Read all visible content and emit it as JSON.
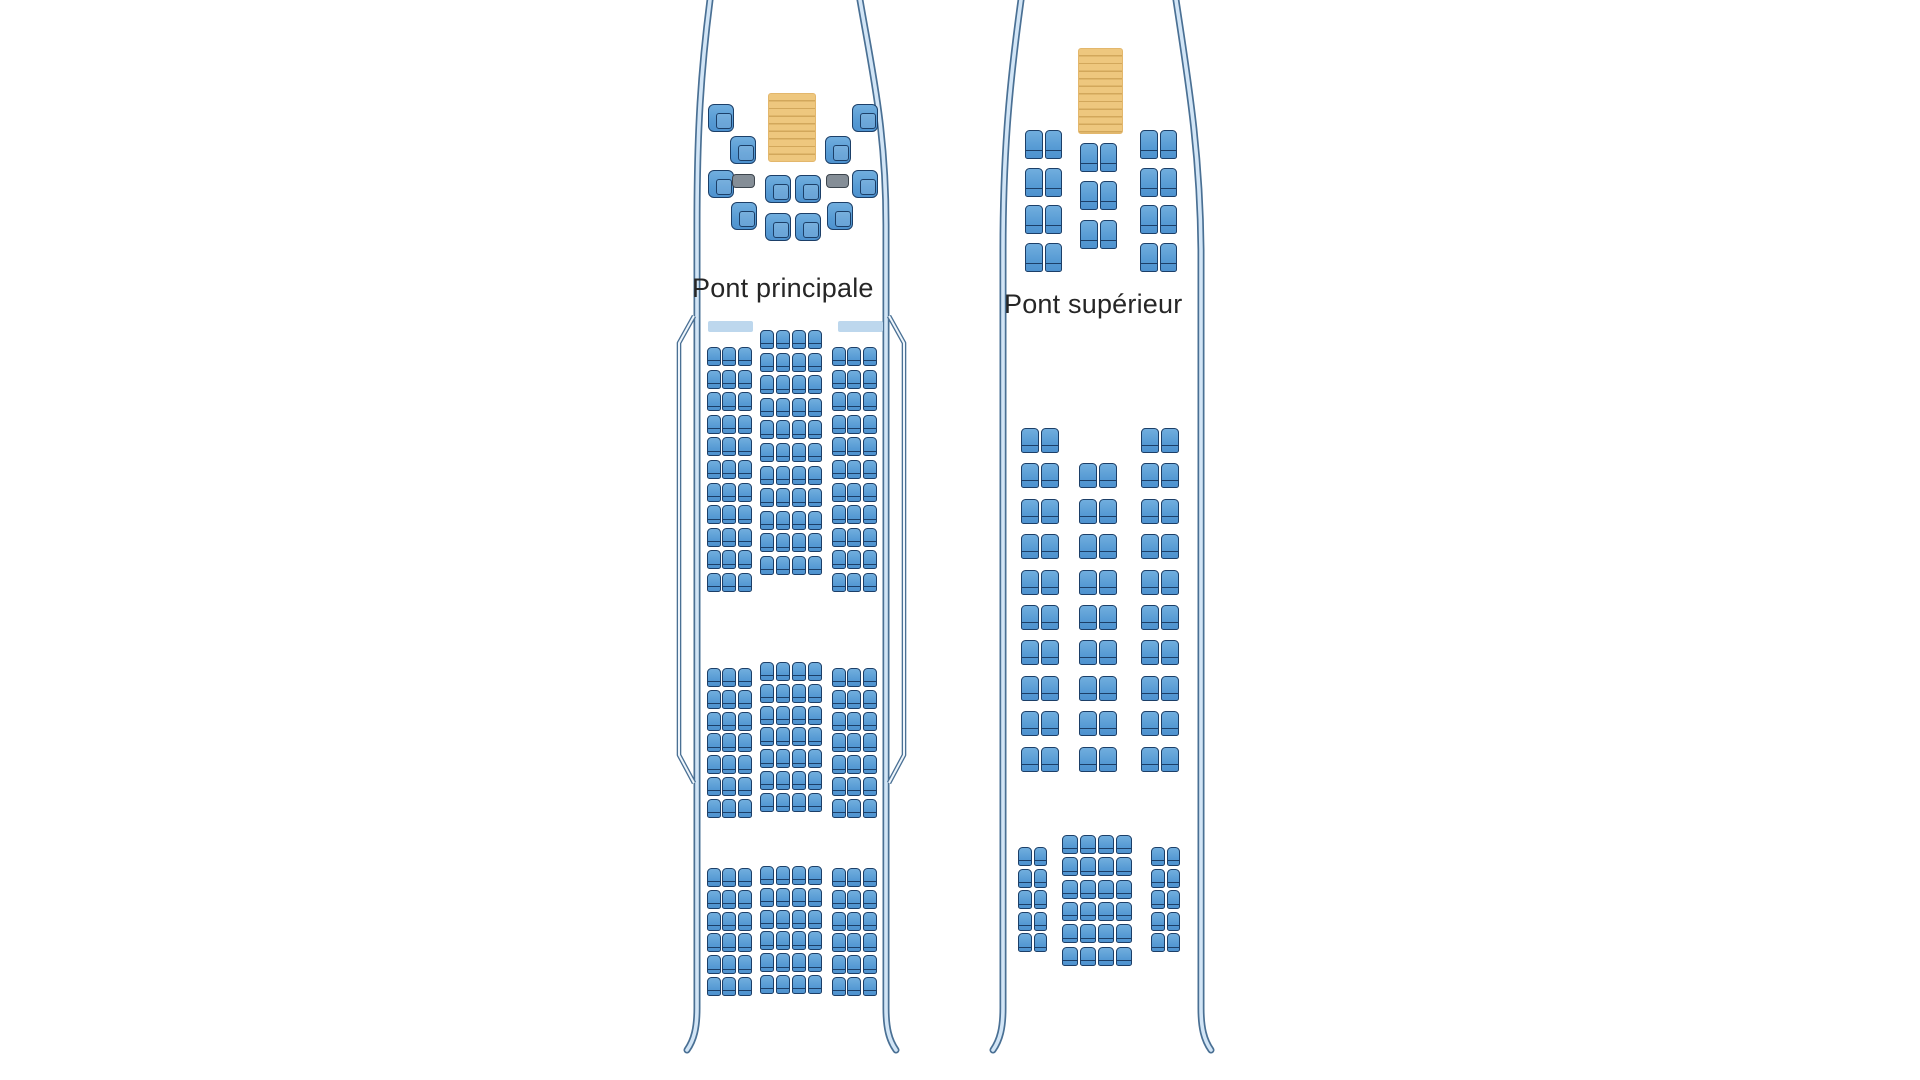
{
  "diagram_type": "aircraft-seat-map",
  "colors": {
    "seat_fill": "#5b9bd5",
    "seat_border": "#1c3f68",
    "ottoman_fill": "#858e97",
    "ottoman_border": "#3d454d",
    "stairs_fill": "#eec77e",
    "stairs_step_line": "#d2a75b",
    "exit_marker_fill": "#bdd7ed",
    "fuselage_outline_dark": "#4a7094",
    "fuselage_outline_light": "#d2e5f6",
    "label_text": "#262626",
    "background": "#ffffff"
  },
  "decks": [
    {
      "id": "pont-principal",
      "label": "Pont principale",
      "stairs": {
        "x": 768,
        "y": 93,
        "w": 48,
        "h": 69
      },
      "exit_markers": [
        {
          "x": 708,
          "y": 321,
          "w": 45,
          "h": 11
        },
        {
          "x": 838,
          "y": 321,
          "w": 45,
          "h": 11
        }
      ],
      "first_class_seats": {
        "w": 26,
        "h": 28,
        "positions": [
          [
            708,
            104
          ],
          [
            852,
            104
          ],
          [
            730,
            136
          ],
          [
            825,
            136
          ],
          [
            708,
            170
          ],
          [
            765,
            175
          ],
          [
            795,
            175
          ],
          [
            852,
            170
          ],
          [
            731,
            202
          ],
          [
            765,
            213
          ],
          [
            795,
            213
          ],
          [
            827,
            202
          ]
        ]
      },
      "ottomans": {
        "w": 23,
        "h": 14,
        "positions": [
          [
            732,
            174
          ],
          [
            826,
            174
          ]
        ]
      },
      "seat_blocks": [
        {
          "section": "avant",
          "pos": "left",
          "class_name": "economy",
          "style": "eco",
          "x": 707,
          "y": 347,
          "cols": 3,
          "col_pitch": 15.4,
          "rows": 11,
          "row_pitch": 22.6,
          "seat_w": 13.8,
          "seat_h": 19
        },
        {
          "section": "avant",
          "pos": "center",
          "class_name": "economy",
          "style": "eco",
          "x": 760,
          "y": 330,
          "cols": 4,
          "col_pitch": 15.9,
          "rows": 11,
          "row_pitch": 22.6,
          "seat_w": 14.2,
          "seat_h": 19
        },
        {
          "section": "avant",
          "pos": "right",
          "class_name": "economy",
          "style": "eco",
          "x": 832,
          "y": 347,
          "cols": 3,
          "col_pitch": 15.4,
          "rows": 11,
          "row_pitch": 22.6,
          "seat_w": 13.8,
          "seat_h": 19
        },
        {
          "section": "milieu",
          "pos": "left",
          "class_name": "economy",
          "style": "eco",
          "x": 707,
          "y": 668,
          "cols": 3,
          "col_pitch": 15.4,
          "rows": 7,
          "row_pitch": 21.8,
          "seat_w": 13.8,
          "seat_h": 19
        },
        {
          "section": "milieu",
          "pos": "center",
          "class_name": "economy",
          "style": "eco",
          "x": 760,
          "y": 662,
          "cols": 4,
          "col_pitch": 15.9,
          "rows": 7,
          "row_pitch": 21.8,
          "seat_w": 14.2,
          "seat_h": 19
        },
        {
          "section": "milieu",
          "pos": "right",
          "class_name": "economy",
          "style": "eco",
          "x": 832,
          "y": 668,
          "cols": 3,
          "col_pitch": 15.4,
          "rows": 7,
          "row_pitch": 21.8,
          "seat_w": 13.8,
          "seat_h": 19
        },
        {
          "section": "arriere",
          "pos": "left",
          "class_name": "economy",
          "style": "eco",
          "x": 707,
          "y": 868,
          "cols": 3,
          "col_pitch": 15.4,
          "rows": 6,
          "row_pitch": 21.8,
          "seat_w": 13.8,
          "seat_h": 19
        },
        {
          "section": "arriere",
          "pos": "center",
          "class_name": "economy",
          "style": "eco",
          "x": 760,
          "y": 866,
          "cols": 4,
          "col_pitch": 15.9,
          "rows": 6,
          "row_pitch": 21.8,
          "seat_w": 14.2,
          "seat_h": 19
        },
        {
          "section": "arriere",
          "pos": "right",
          "class_name": "economy",
          "style": "eco",
          "x": 832,
          "y": 868,
          "cols": 3,
          "col_pitch": 15.4,
          "rows": 6,
          "row_pitch": 21.8,
          "seat_w": 13.8,
          "seat_h": 19
        }
      ]
    },
    {
      "id": "pont-superieur",
      "label": "Pont supérieur",
      "stairs": {
        "x": 1078,
        "y": 48,
        "w": 45,
        "h": 86
      },
      "exit_markers": [],
      "seat_blocks": [
        {
          "section": "affaires",
          "pos": "left",
          "class_name": "business",
          "style": "biz",
          "x": 1025,
          "y": 130,
          "cols": 2,
          "col_pitch": 19.5,
          "rows": 4,
          "row_pitch": 37.6,
          "seat_w": 17.5,
          "seat_h": 29
        },
        {
          "section": "affaires",
          "pos": "center",
          "class_name": "business",
          "style": "biz",
          "x": 1080,
          "y": 143,
          "cols": 2,
          "col_pitch": 19.5,
          "rows": 3,
          "row_pitch": 38.3,
          "seat_w": 17.5,
          "seat_h": 29
        },
        {
          "section": "affaires",
          "pos": "right",
          "class_name": "business",
          "style": "biz",
          "x": 1140,
          "y": 130,
          "cols": 2,
          "col_pitch": 19.5,
          "rows": 4,
          "row_pitch": 37.6,
          "seat_w": 17.5,
          "seat_h": 29
        },
        {
          "section": "premium",
          "pos": "left",
          "class_name": "premium",
          "style": "prem",
          "x": 1021,
          "y": 428,
          "cols": 2,
          "col_pitch": 20,
          "rows": 10,
          "row_pitch": 35.4,
          "seat_w": 18,
          "seat_h": 25
        },
        {
          "section": "premium",
          "pos": "center",
          "class_name": "premium",
          "style": "prem",
          "x": 1079,
          "y": 463.4,
          "cols": 2,
          "col_pitch": 20,
          "rows": 9,
          "row_pitch": 35.4,
          "seat_w": 18,
          "seat_h": 25
        },
        {
          "section": "premium",
          "pos": "right",
          "class_name": "premium",
          "style": "prem",
          "x": 1141,
          "y": 428,
          "cols": 2,
          "col_pitch": 20,
          "rows": 10,
          "row_pitch": 35.4,
          "seat_w": 18,
          "seat_h": 25
        },
        {
          "section": "arriere",
          "pos": "left",
          "class_name": "economy",
          "style": "eco",
          "x": 1018,
          "y": 847,
          "cols": 2,
          "col_pitch": 15.5,
          "rows": 5,
          "row_pitch": 21.6,
          "seat_w": 13.5,
          "seat_h": 19
        },
        {
          "section": "arriere",
          "pos": "center",
          "class_name": "economy",
          "style": "eco",
          "x": 1062,
          "y": 835,
          "cols": 4,
          "col_pitch": 18,
          "rows": 6,
          "row_pitch": 22.3,
          "seat_w": 16,
          "seat_h": 19
        },
        {
          "section": "arriere",
          "pos": "right",
          "class_name": "economy",
          "style": "eco",
          "x": 1151,
          "y": 847,
          "cols": 2,
          "col_pitch": 15.5,
          "rows": 5,
          "row_pitch": 21.6,
          "seat_w": 13.5,
          "seat_h": 19
        }
      ]
    }
  ]
}
